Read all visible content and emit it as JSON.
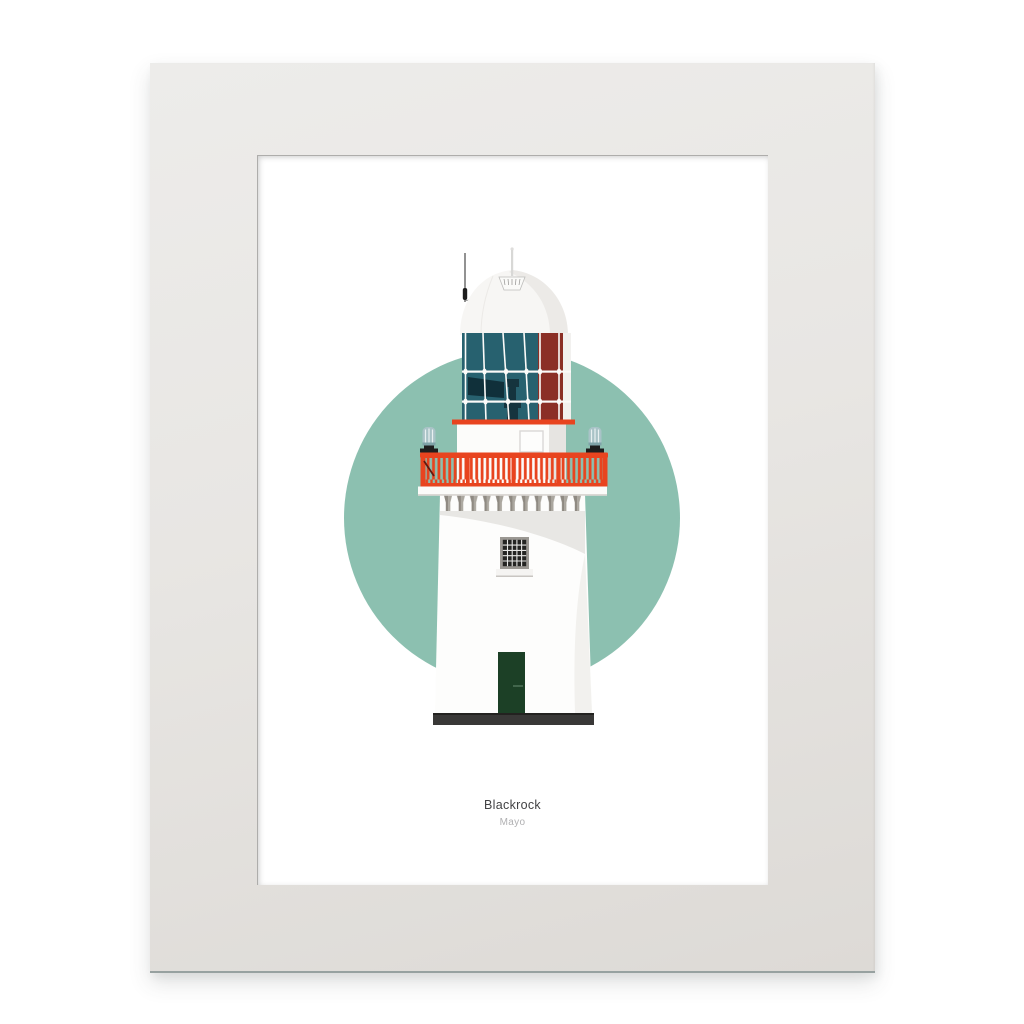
{
  "artwork": {
    "title": "Blackrock",
    "county": "Mayo"
  },
  "palette": {
    "paper": "#ffffff",
    "frame": "#e8e6e3",
    "frame_edge": "#97a1a0",
    "mat_bevel": "#aeadab",
    "circle": "#8cc0b0",
    "glass": "#27616f",
    "panel_red": "#8b2f26",
    "accent_red": "#e8441f",
    "dome_white": "#f7f6f4",
    "shade_gray": "#e8e7e4",
    "corbel_gray": "#aba79f",
    "beacon": "#a9c3c7",
    "door_green": "#1c4026",
    "base_dark": "#393837",
    "window_dark": "#242422",
    "lamp_dark": "#15343e",
    "title": "#424244",
    "county": "#b0b0b2"
  }
}
